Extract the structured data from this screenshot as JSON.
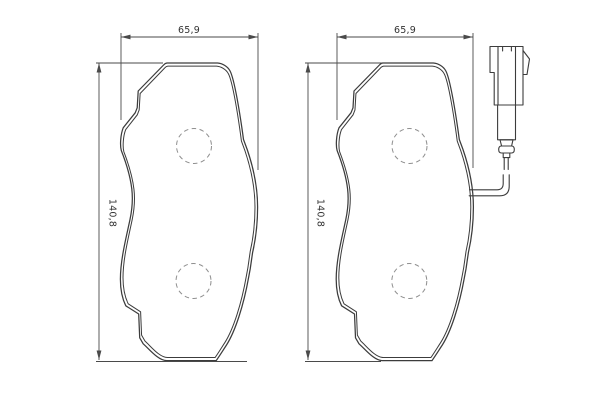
{
  "diagram": {
    "type": "technical-drawing",
    "subject": "disc-brake-pad-set",
    "background_color": "#ffffff",
    "outline_color": "#3c3c3c",
    "dimension_color": "#4a4a4a",
    "text_color": "#333333",
    "hole_color": "#8f8f8f",
    "views": [
      {
        "name": "pad-plain",
        "width_label": "65,9",
        "height_label": "140,8",
        "rivet_holes": 2,
        "wear_sensor": false
      },
      {
        "name": "pad-with-wear-sensor",
        "width_label": "65,9",
        "height_label": "140,8",
        "rivet_holes": 2,
        "wear_sensor": true
      }
    ]
  }
}
